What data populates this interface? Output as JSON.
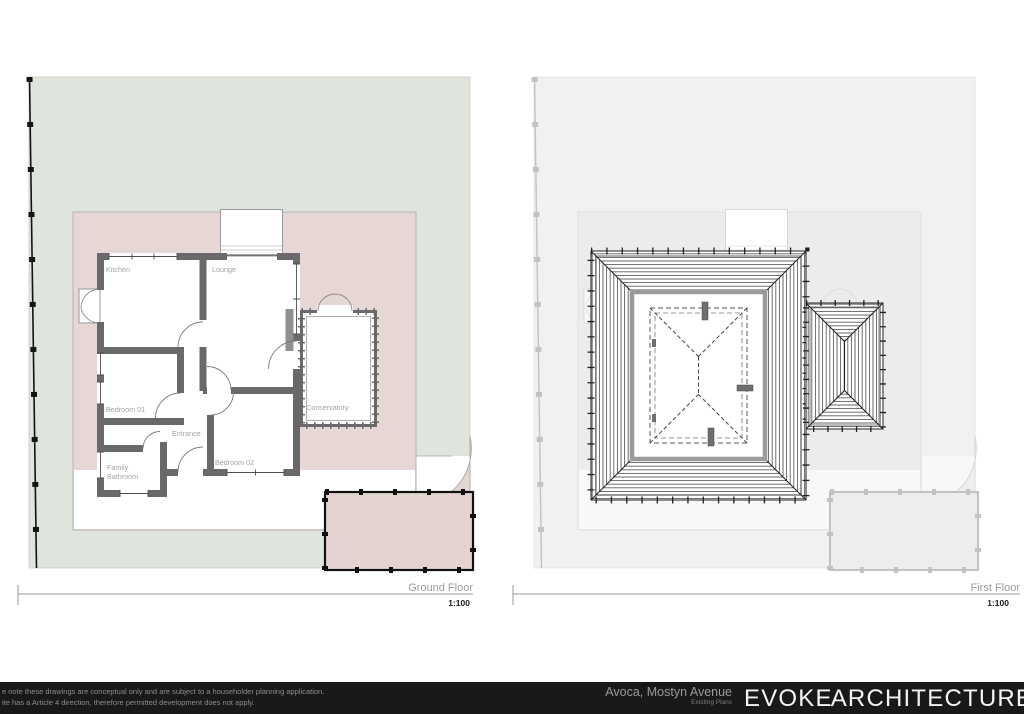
{
  "ground_floor": {
    "title": "Ground Floor",
    "scale": "1:100",
    "rooms": {
      "kitchen": "Kitchen",
      "lounge": "Lounge",
      "bedroom01": "Bedroom 01",
      "entrance": "Entrance",
      "bedroom02": "Bedroom 02",
      "family_bathroom_line1": "Family",
      "family_bathroom_line2": "Bathroom",
      "conservatory": "Conservatory"
    }
  },
  "first_floor": {
    "title": "First Floor",
    "scale": "1:100"
  },
  "footer": {
    "note_line1": "e note these drawings are conceptual only and are subject to a householder planning application.",
    "note_line2": "ite has a Article 4 direction, therefore permitted development does not apply.",
    "project": "Avoca, Mostyn Avenue",
    "drawing_set": "Existing Plans",
    "logo_part1": "EVOKE",
    "logo_part2": "ARCHITECTURE"
  },
  "colors": {
    "site_green": "#dfe4dd",
    "garden_pink": "#e6d7d4",
    "wall_gray": "#696969",
    "footer_bg": "#191919",
    "logo_color": "#f4f4f4"
  }
}
